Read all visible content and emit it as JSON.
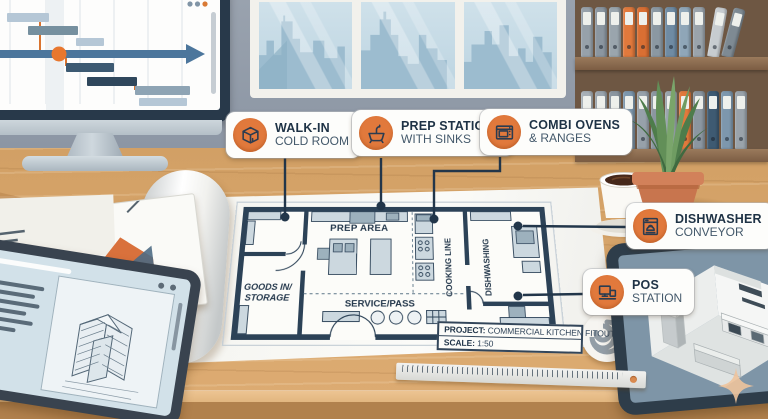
{
  "callouts": [
    {
      "id": "walk-in-cold-room",
      "title": "WALK-IN",
      "subtitle": "COLD ROOM",
      "icon": "cube-icon"
    },
    {
      "id": "prep-stations",
      "title": "PREP STATIONS",
      "subtitle": "WITH SINKS",
      "icon": "sink-icon"
    },
    {
      "id": "combi-ovens",
      "title": "COMBI OVENS",
      "subtitle": "& RANGES",
      "icon": "oven-icon"
    },
    {
      "id": "dishwasher-conveyor",
      "title": "DISHWASHER",
      "subtitle": "CONVEYOR",
      "icon": "dishwasher-icon"
    },
    {
      "id": "pos-station",
      "title": "POS",
      "subtitle": "STATION",
      "icon": "pos-icon"
    }
  ],
  "blueprint": {
    "rooms": {
      "prep": "PREP AREA",
      "storage1": "GOODS IN/",
      "storage2": "STORAGE",
      "service": "SERVICE/PASS",
      "cooking": "COOKING LINE",
      "dishwashing": "DISHWASHING"
    },
    "title_block": {
      "project_label": "PROJECT:",
      "project_value": " COMMERCIAL KITCHEN FITOUT",
      "scale_label": "SCALE:",
      "scale_value": " 1:50"
    }
  },
  "colors": {
    "accent_orange": "#e1793c",
    "ink": "#22364a",
    "paper": "#f6f6f2",
    "wall": "#8c96a4",
    "desk_wood": "#d9a76d"
  },
  "monitor": {
    "gantt": {
      "bars": [
        {
          "x": 19,
          "y": 21,
          "w": 42,
          "h": 9,
          "c": "#b5c7d6"
        },
        {
          "x": 40,
          "y": 34,
          "w": 50,
          "h": 9,
          "c": "#76909f"
        },
        {
          "x": 88,
          "y": 46,
          "w": 28,
          "h": 8,
          "c": "#b5c7d6"
        },
        {
          "x": 78,
          "y": 71,
          "w": 48,
          "h": 9,
          "c": "#3d5a72"
        },
        {
          "x": 99,
          "y": 85,
          "w": 50,
          "h": 9,
          "c": "#2f475c"
        },
        {
          "x": 147,
          "y": 94,
          "w": 55,
          "h": 9,
          "c": "#8ea4b4"
        },
        {
          "x": 151,
          "y": 106,
          "w": 48,
          "h": 8,
          "c": "#b5c7d6"
        }
      ],
      "connectors": [
        {
          "x": 52,
          "y1": 27,
          "y2": 60
        },
        {
          "x": 78,
          "y1": 64,
          "y2": 74
        },
        {
          "x": 147,
          "y1": 90,
          "y2": 98
        }
      ],
      "connector_color": "#d9742f",
      "milestone_color": "#e8772e",
      "timeline_color": "#4c769c"
    }
  },
  "shelf": {
    "row1": [
      {
        "c": "#97a1aa"
      },
      {
        "c": "#8b96a0"
      },
      {
        "c": "#9aa5ad"
      },
      {
        "c": "#e1793c"
      },
      {
        "c": "#d96f33"
      },
      {
        "c": "#8b98a2"
      },
      {
        "c": "#6f8ba3"
      },
      {
        "c": "#8fa6b8"
      },
      {
        "c": "#9aa3ab"
      },
      {
        "c": "#c7ccd0",
        "t": 10
      },
      {
        "c": "#7e8a93",
        "t": 15
      }
    ],
    "row2": [
      {
        "c": "#a8b0b7"
      },
      {
        "c": "#9aa4ad"
      },
      {
        "c": "#8b96a0"
      },
      {
        "c": "#7d97ad"
      },
      {
        "c": "#97a1aa"
      },
      {
        "c": "#8b96a0"
      },
      {
        "c": "#9aa5ad"
      },
      {
        "c": "#e1793c"
      },
      {
        "c": "#8b96a0"
      },
      {
        "c": "#3e5a72"
      },
      {
        "c": "#7d97ad"
      },
      {
        "c": "#9aa3ab"
      }
    ]
  }
}
